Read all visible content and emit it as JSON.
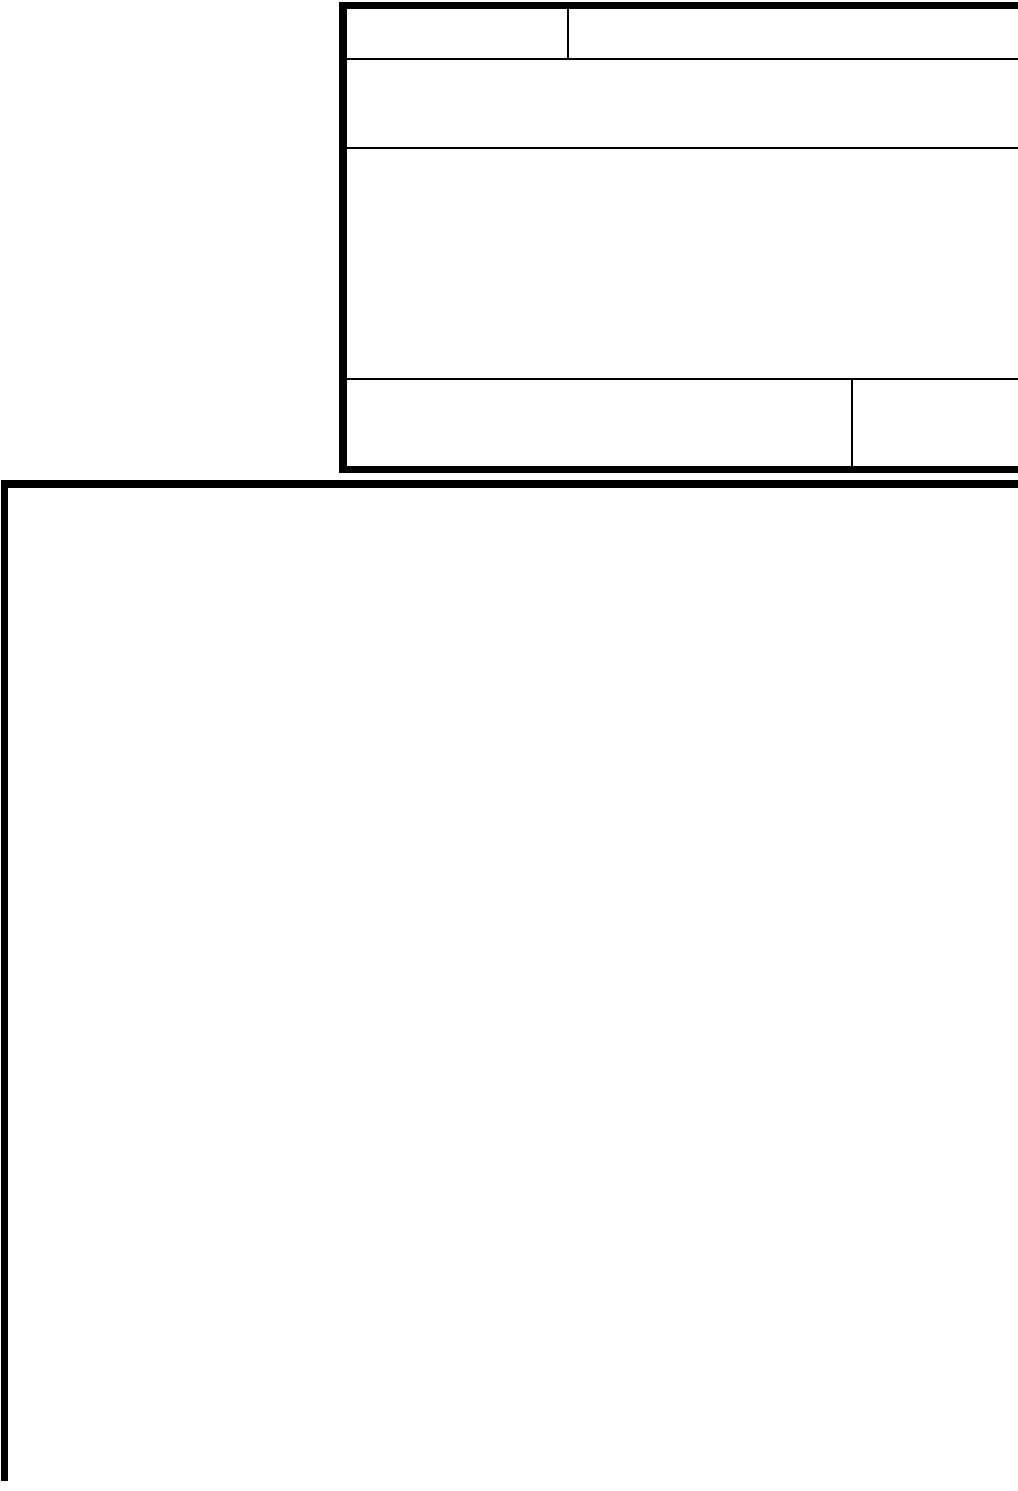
{
  "colors": {
    "ink": "#000000",
    "paper": "#ffffff"
  },
  "header_table": {
    "rows": [
      {
        "cells": [
          "",
          ""
        ]
      },
      {
        "cells": [
          ""
        ]
      },
      {
        "cells": [
          ""
        ]
      },
      {
        "cells": [
          "",
          ""
        ]
      }
    ]
  },
  "main_box": {
    "content": ""
  }
}
